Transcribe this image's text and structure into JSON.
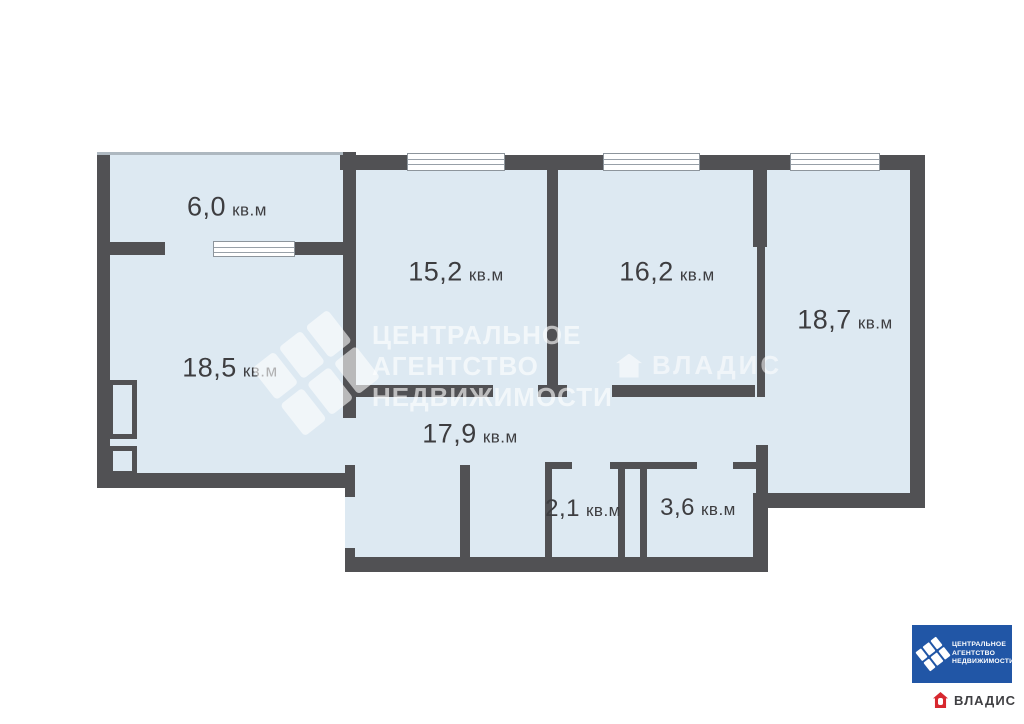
{
  "plan_title": "floor-plan",
  "unit_label": "кв.м",
  "rooms": {
    "balcony": {
      "area": "6,0",
      "unit": "кв.м"
    },
    "living": {
      "area": "18,5",
      "unit": "кв.м"
    },
    "bedroom1": {
      "area": "15,2",
      "unit": "кв.м"
    },
    "bedroom2": {
      "area": "16,2",
      "unit": "кв.м"
    },
    "bedroom3": {
      "area": "18,7",
      "unit": "кв.м"
    },
    "hallway": {
      "area": "17,9",
      "unit": "кв.м"
    },
    "wc": {
      "area": "2,1",
      "unit": "кв.м"
    },
    "bathroom": {
      "area": "3,6",
      "unit": "кв.м"
    }
  },
  "watermark_center": {
    "line1": "ЦЕНТРАЛЬНОЕ",
    "line2": "АГЕНТСТВО",
    "line3": "НЕДВИЖИМОСТИ"
  },
  "watermark_vladis": {
    "text": "ВЛАДИС"
  },
  "logo_can": {
    "line1": "ЦЕНТРАЛЬНОЕ",
    "line2": "АГЕНТСТВО",
    "line3": "НЕДВИЖИМОСТИ"
  },
  "logo_vladis": {
    "text": "ВЛАДИС"
  },
  "colors": {
    "wall": "#515154",
    "room_fill": "#dde9f2",
    "logo_blue": "#2156a6",
    "vladis_red": "#d7282f"
  }
}
